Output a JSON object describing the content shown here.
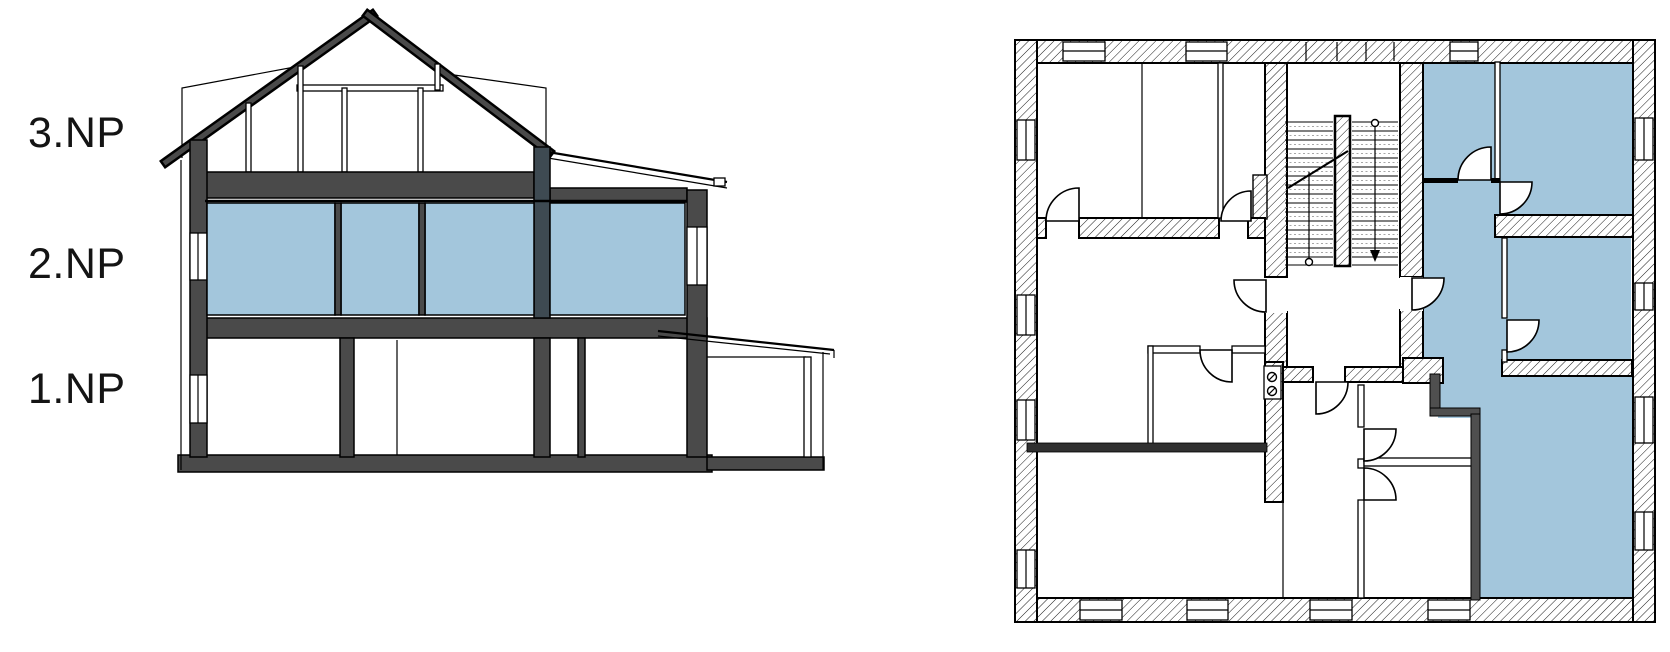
{
  "page": {
    "background": "#ffffff"
  },
  "floor_labels": [
    {
      "id": "3np",
      "text": "3.NP"
    },
    {
      "id": "2np",
      "text": "2.NP"
    },
    {
      "id": "1np",
      "text": "1.NP"
    }
  ],
  "colors": {
    "highlight_blue": "#a3c6dc",
    "wall_dark_gray": "#4a4a4a",
    "pier_slate": "#3e4a52",
    "solid_wall_dark": "#4f4f4f",
    "near_black_wall": "#303030",
    "outline_black": "#000000"
  }
}
